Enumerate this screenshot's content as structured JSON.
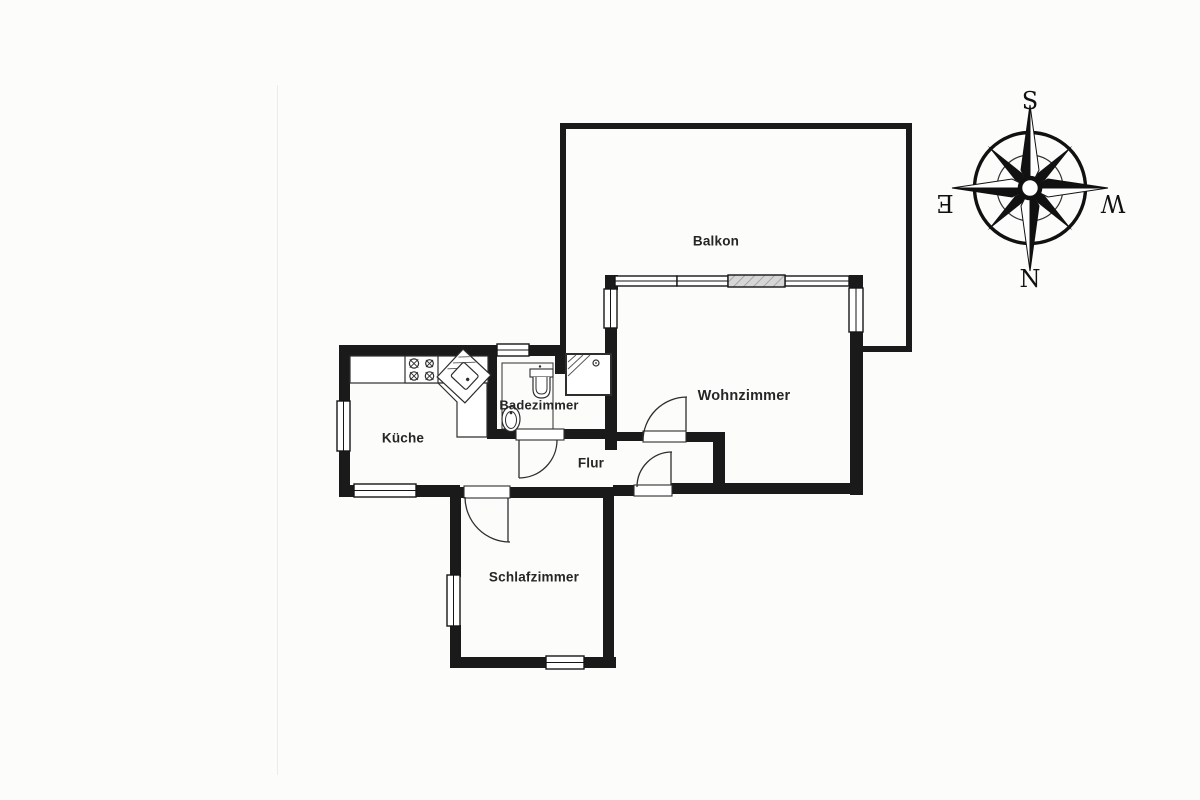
{
  "rooms": [
    {
      "id": "balkon",
      "label": "Balkon"
    },
    {
      "id": "wohnzimmer",
      "label": "Wohnzimmer"
    },
    {
      "id": "kueche",
      "label": "Küche"
    },
    {
      "id": "badezimmer",
      "label": "Badezimmer"
    },
    {
      "id": "flur",
      "label": "Flur"
    },
    {
      "id": "schlafzimmer",
      "label": "Schlafzimmer"
    }
  ],
  "compass": {
    "top": "S",
    "bottom": "N",
    "left": "E",
    "right": "W"
  },
  "colors": {
    "wall": "#1a1a1a",
    "thin_line": "#333333",
    "background": "#fcfcfb",
    "label": "#262626",
    "balcony_door_fill": "#d6d6d6",
    "balcony_door_hatch": "#9a9a9a"
  }
}
